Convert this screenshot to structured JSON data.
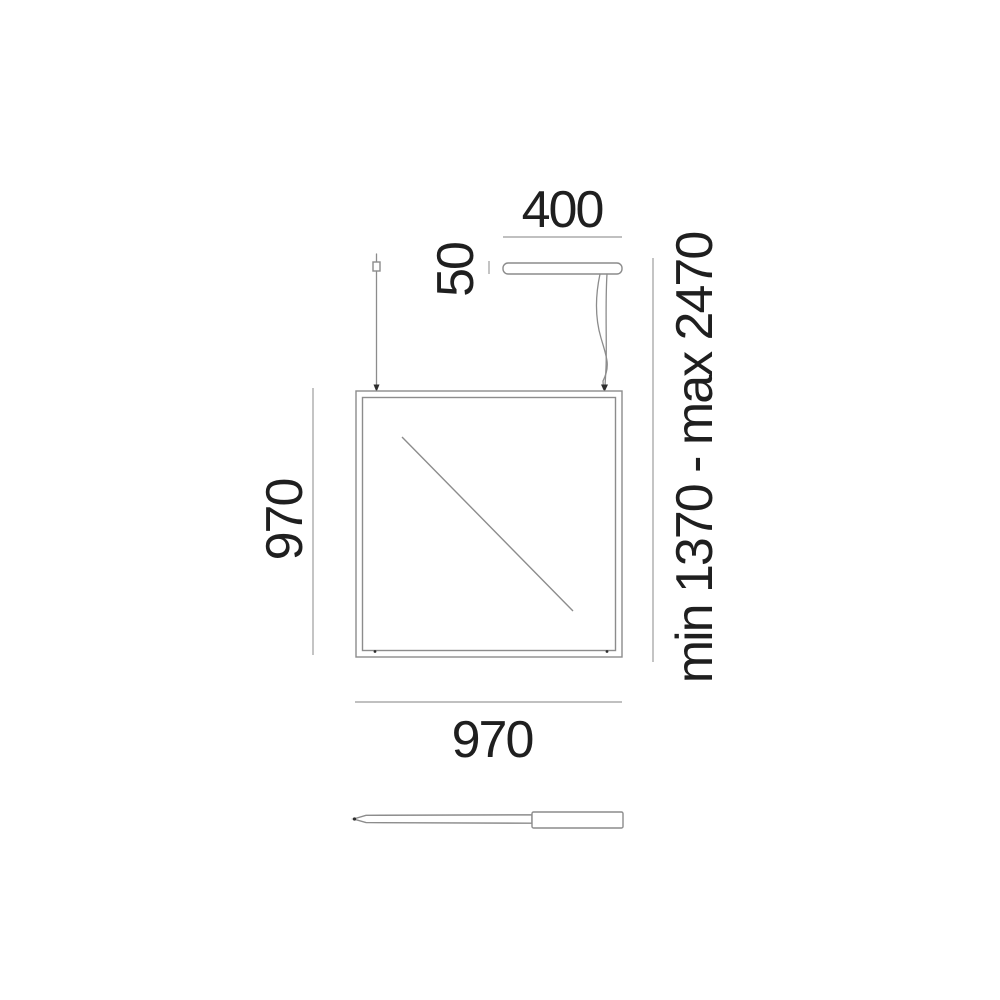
{
  "drawing": {
    "kind": "technical-dimension-diagram",
    "labels": {
      "canopy_width": "400",
      "canopy_height": "50",
      "panel_height": "970",
      "panel_width": "970",
      "suspension_range": "min 1370 - max 2470"
    },
    "colors": {
      "background": "#ffffff",
      "outline": "#8c8c8c",
      "dimension_line": "#ababab",
      "text": "#1f1f1f",
      "marker": "#2e2e2e"
    }
  }
}
